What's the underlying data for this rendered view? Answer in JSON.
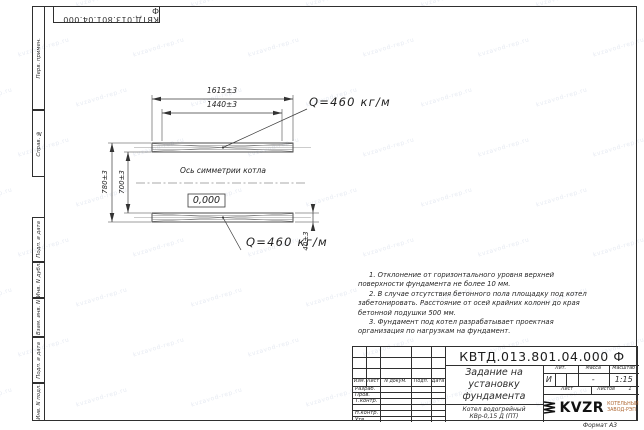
{
  "watermark": {
    "text": "kvzavod-rep.ru"
  },
  "top_stamp": {
    "designation": "КВТД.013.801.04.000 Ф"
  },
  "margin": {
    "perv_primen": "Перв. примен.",
    "sprav_n": "Справ. №",
    "podp_data_1": "Подп. и дата",
    "inv_dubl": "Инв. N дубл.",
    "vzam_inv": "Взам. инв. N",
    "podp_data_2": "Подп. и дата",
    "inv_podl": "Инв. N подл."
  },
  "drawing": {
    "dim_length_outer": "1615±3",
    "dim_length_inner": "1440±3",
    "dim_width_outer": "780±3",
    "dim_width_inner": "700±3",
    "dim_channel": "40±3",
    "load_top": "Q=460 кг/м",
    "load_bottom": "Q=460 кг/м",
    "axis_label": "Ось симметрии котла",
    "elevation_mark": "0,000"
  },
  "notes": {
    "items": [
      "1. Отклонение от горизонтального уровня верхней поверхности фундамента не более 10 мм.",
      "2. В случае отсутствия бетонного пола площадку под котел забетонировать. Расстояние от осей крайних колонн до края бетонной подушки 500 мм.",
      "3. Фундамент под котел разрабатывает проектная организация по нагрузкам на фундамент."
    ]
  },
  "title_block": {
    "designation": "КВТД.013.801.04.000 Ф",
    "document_title": "Задание на установку фундамента",
    "product": "Котел водогрейный\nКВр-0,15 Д (ПТ)",
    "columns": {
      "izm": "Изм.",
      "list": "Лист",
      "doc": "N докум.",
      "sign": "Подп.",
      "date": "Дата"
    },
    "rows": [
      "Разраб.",
      "Пров.",
      "Т.контр.",
      "",
      "Н.контр.",
      "Утв."
    ],
    "lit_header": "Лит.",
    "mass_header": "Масса",
    "scale_header": "Масштаб",
    "lit_value": "И",
    "mass_value": "-",
    "scale_value": "1:15",
    "sheet_label": "Лист",
    "sheets_label": "Листов",
    "sheets_value": "1",
    "logo": {
      "name": "KVZR",
      "org": "КОТЕЛЬНЫЙ\nЗАВОД-РЭП"
    },
    "format_note": "Формат А3"
  }
}
